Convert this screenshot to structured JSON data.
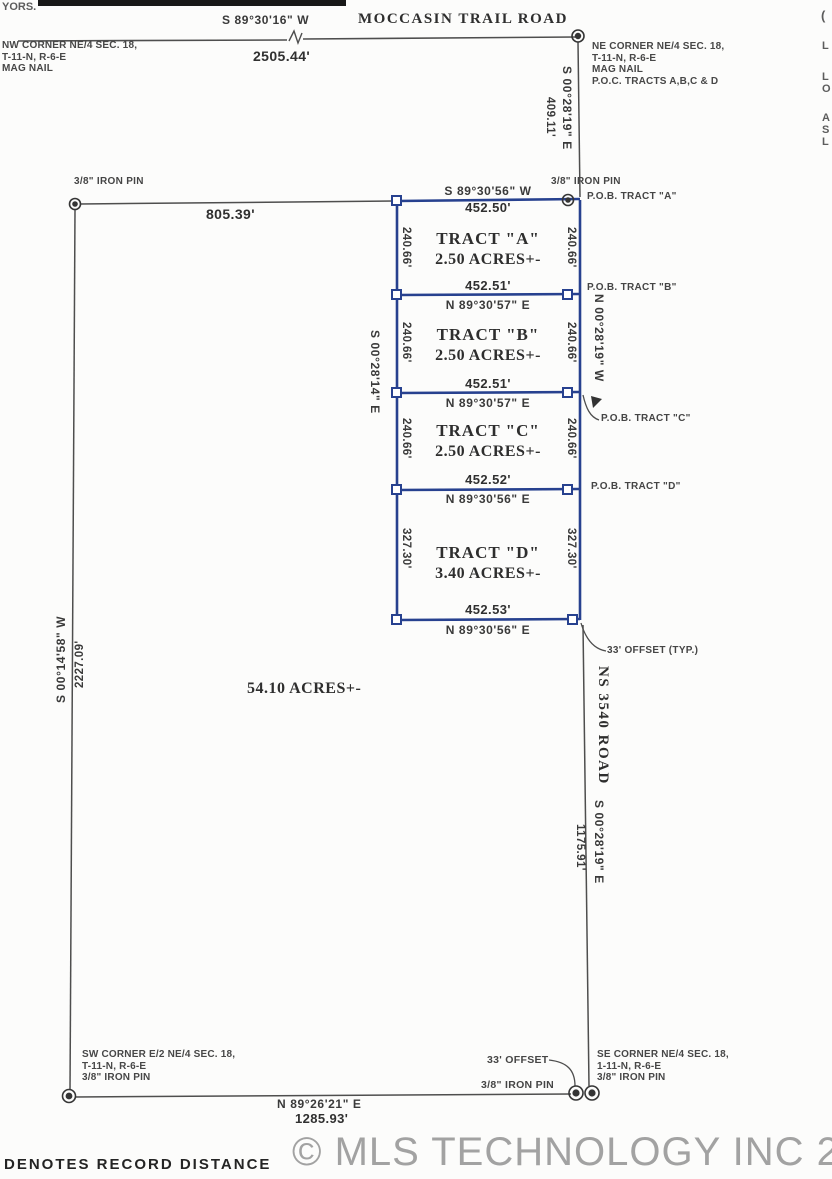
{
  "page": {
    "scan_fragment_top_left": "YORS.",
    "right_edge_fragments": [
      "(",
      "L",
      "L",
      "O",
      "A",
      "S",
      "L"
    ],
    "legend": "DENOTES RECORD DISTANCE",
    "watermark": "© MLS TECHNOLOGY INC 2026"
  },
  "colors": {
    "tract_boundary_blue": "#27418f",
    "survey_line_gray": "#4e4e4e",
    "ink": "#3d3d3d",
    "watermark_gray": "#a2a2a2"
  },
  "top_road": {
    "bearing": "S 89°30'16\" W",
    "name": "MOCCASIN TRAIL ROAD",
    "distance": "2505.44'"
  },
  "corner_notes": {
    "nw": [
      "NW CORNER NE/4 SEC. 18,",
      "T-11-N, R-6-E",
      "MAG NAIL"
    ],
    "ne": [
      "NE CORNER NE/4 SEC. 18,",
      "T-11-N, R-6-E",
      "MAG NAIL",
      "P.O.C. TRACTS A,B,C & D"
    ],
    "sw": [
      "SW CORNER E/2 NE/4 SEC. 18,",
      "T-11-N, R-6-E",
      "3/8\" IRON PIN"
    ],
    "se": [
      "SE CORNER NE/4 SEC. 18,",
      "1-11-N, R-6-E",
      "3/8\" IRON PIN"
    ]
  },
  "east_tie": {
    "bearing": "S 00°28'19\" E",
    "distance": "409.11'"
  },
  "north_line": {
    "pin_left": "3/8\" IRON PIN",
    "distance": "805.39'",
    "pin_right": "3/8\" IRON PIN"
  },
  "tract_block": {
    "top_bearing": "S 89°30'56\" W",
    "top_distance": "452.50'",
    "west_bearing": "S 00°28'14\" E",
    "east_bearing": "N 00°28'19\" W",
    "offset_note": "33' OFFSET (TYP.)",
    "tracts": [
      {
        "name": "TRACT \"A\"",
        "area": "2.50 ACRES+-",
        "side_west": "240.66'",
        "side_east": "240.66'",
        "south_distance": "452.51'",
        "south_bearing": "N 89°30'57\" E",
        "pob": "P.O.B. TRACT \"A\""
      },
      {
        "name": "TRACT \"B\"",
        "area": "2.50 ACRES+-",
        "side_west": "240.66'",
        "side_east": "240.66'",
        "south_distance": "452.51'",
        "south_bearing": "N 89°30'57\" E",
        "pob": "P.O.B. TRACT \"B\""
      },
      {
        "name": "TRACT \"C\"",
        "area": "2.50 ACRES+-",
        "side_west": "240.66'",
        "side_east": "240.66'",
        "south_distance": "452.52'",
        "south_bearing": "N 89°30'56\" E",
        "pob": "P.O.B. TRACT \"C\""
      },
      {
        "name": "TRACT \"D\"",
        "area": "3.40 ACRES+-",
        "side_west": "327.30'",
        "side_east": "327.30'",
        "south_distance": "452.53'",
        "south_bearing": "N 89°30'56\" E",
        "pob": "P.O.B. TRACT \"D\""
      }
    ]
  },
  "parent_parcel": {
    "area": "54.10 ACRES+-"
  },
  "west_line": {
    "bearing": "S 00°14'58\" W",
    "distance": "2227.09'"
  },
  "east_road": {
    "name": "NS 3540 ROAD",
    "bearing": "S 00°28'19\" E",
    "distance": "1175.91'"
  },
  "south_line": {
    "bearing": "N 89°26'21\" E",
    "distance": "1285.93'",
    "offset": "33' OFFSET",
    "offset_pin": "3/8\" IRON PIN"
  }
}
